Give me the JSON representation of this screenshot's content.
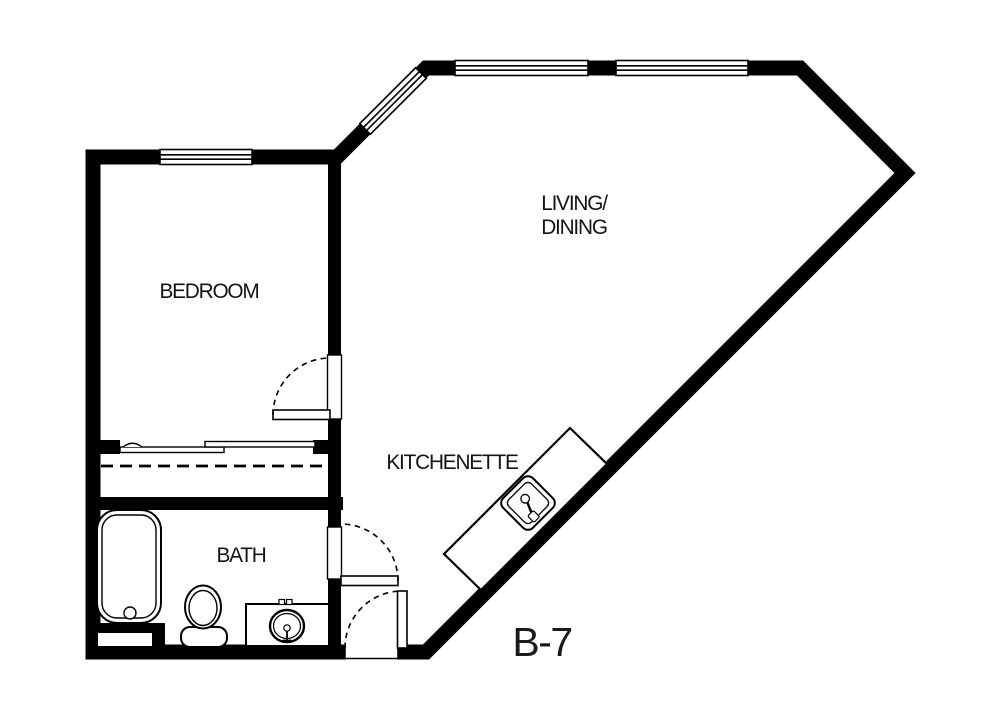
{
  "colors": {
    "walls": "#000000",
    "background": "#ffffff",
    "text": "#141414"
  },
  "labels": {
    "bedroom": "BEDROOM",
    "living_line1": "LIVING/",
    "living_line2": "DINING",
    "kitchenette": "KITCHENETTE",
    "bath": "BATH",
    "unit": "B-7"
  },
  "fixtures": [
    {
      "name": "bathtub",
      "room": "bath"
    },
    {
      "name": "toilet",
      "room": "bath"
    },
    {
      "name": "vanity-sink",
      "room": "bath"
    },
    {
      "name": "kitchen-island-sink",
      "room": "kitchenette"
    },
    {
      "name": "sliding-closet-doors",
      "room": "bedroom-closet"
    },
    {
      "name": "closet-rod-dashed-line",
      "room": "bedroom-closet"
    },
    {
      "name": "swing-door",
      "room": "bedroom"
    },
    {
      "name": "swing-door",
      "room": "bath"
    },
    {
      "name": "swing-door",
      "room": "entry"
    },
    {
      "name": "window",
      "location": "bedroom-north-wall"
    },
    {
      "name": "window",
      "location": "living-northwest-diagonal-wall"
    },
    {
      "name": "window",
      "location": "living-north-wall-left"
    },
    {
      "name": "window",
      "location": "living-north-wall-right"
    }
  ]
}
